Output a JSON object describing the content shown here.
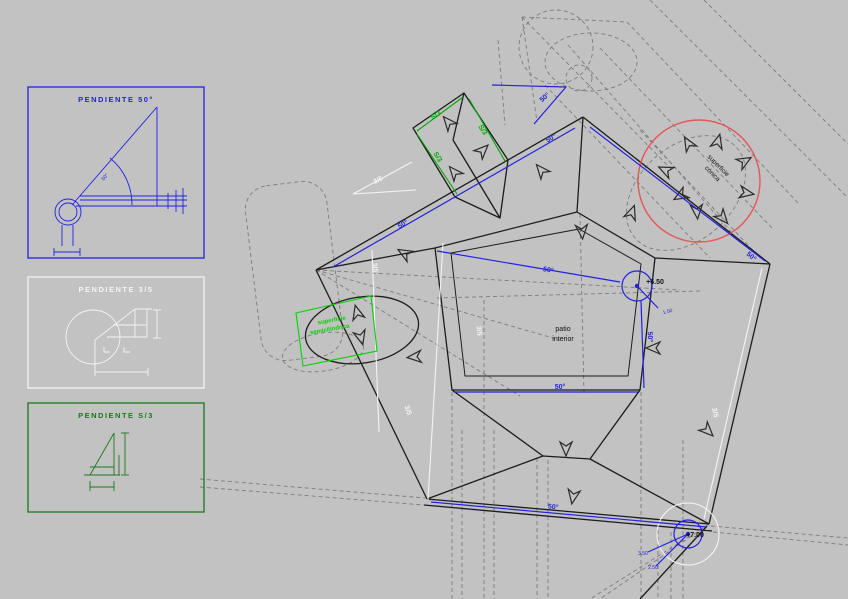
{
  "canvas": {
    "width": 848,
    "height": 599,
    "background": "#c2c2c2"
  },
  "colors": {
    "blue": "#2222e0",
    "dark_green": "#1a7a1a",
    "bright_green": "#00d400",
    "mid_green": "#00a800",
    "white": "#f4f4f4",
    "red": "#e65454",
    "black": "#1c1c1c",
    "dash_gray": "#7c7c7c"
  },
  "legend_boxes": [
    {
      "title": "PENDIENTE 50°"
    },
    {
      "title": "PENDIENTE 3/5"
    },
    {
      "title": "PENDIENTE S/3"
    }
  ],
  "labels": {
    "slope50": "50°",
    "slope35": "3/5",
    "slopeS3": "S/3",
    "patio_line1": "patio",
    "patio_line2": "interior",
    "conica_line1": "superficie",
    "conica_line2": "cónica",
    "semi_line1": "superficie",
    "semi_line2": "semicilíndrica",
    "level_a": "+6.50",
    "level_b": "+7.00",
    "dim_a": "1.50",
    "dim_b": "3.50",
    "dim_c": "2.50",
    "detail_angle": "50°"
  }
}
